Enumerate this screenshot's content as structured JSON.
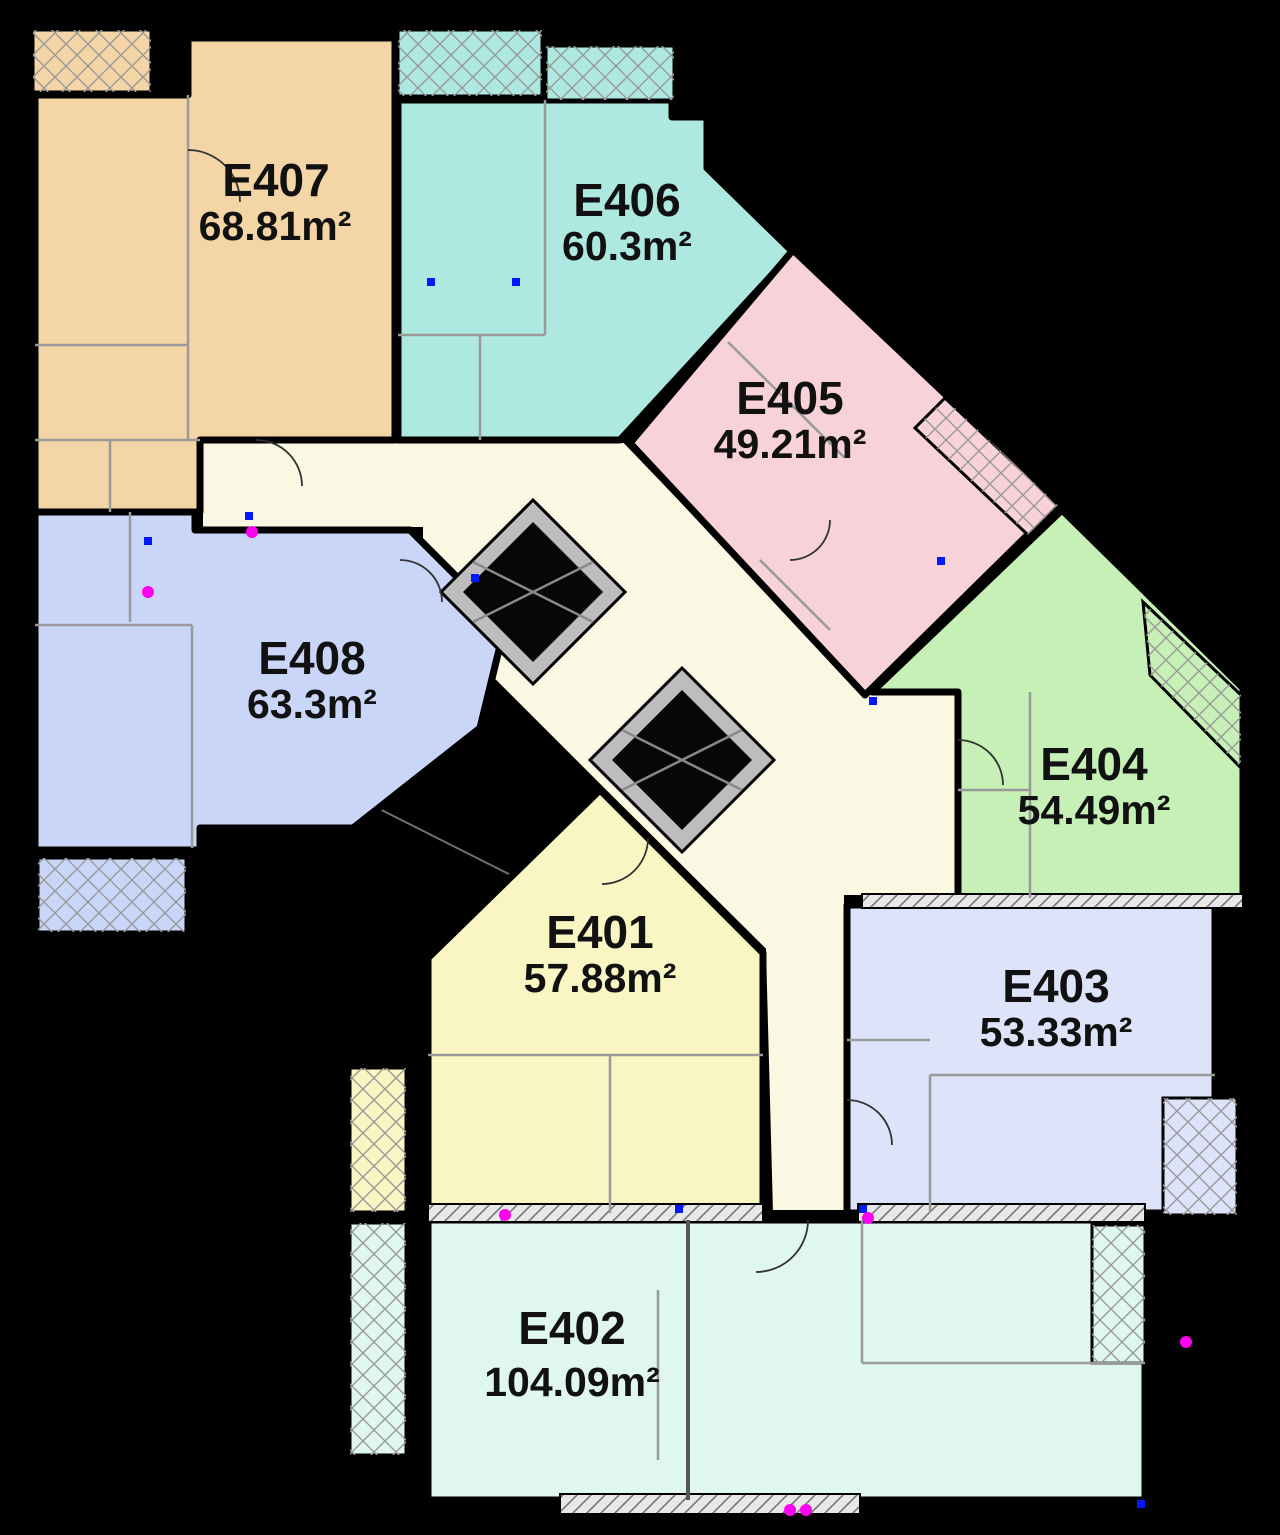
{
  "plan": {
    "type": "apartment-floor-plan",
    "units": [
      {
        "id": "E401",
        "area": "57.88m²",
        "color": "#FAF6C3"
      },
      {
        "id": "E402",
        "area": "104.09m²",
        "color": "#DFF7F0"
      },
      {
        "id": "E403",
        "area": "53.33m²",
        "color": "#DDE3F8"
      },
      {
        "id": "E404",
        "area": "54.49m²",
        "color": "#C6F0B6"
      },
      {
        "id": "E405",
        "area": "49.21m²",
        "color": "#F8D2D9"
      },
      {
        "id": "E406",
        "area": "60.3m²",
        "color": "#ADE9E1"
      },
      {
        "id": "E407",
        "area": "68.81m²",
        "color": "#F4D5A6"
      },
      {
        "id": "E408",
        "area": "63.3m²",
        "color": "#C9D6F7"
      }
    ],
    "colors": {
      "background": "#000000",
      "corridor": "#FAF8E2",
      "wall": "#000000",
      "stairwell": "#000000",
      "elevator_ring": "#BDBDBD",
      "elevator_shaft": "#070707",
      "elevator_cross": "#8a8a8a",
      "hatch_line": "#9a9a9a",
      "wall_hatch_bg": "#ffffff",
      "label_text": "#111111",
      "marker_blue": "#0019ff",
      "marker_magenta": "#ff00f0"
    },
    "icons": {
      "elevator": "crossed-shaft-diamond",
      "staircase": "solid-black-flight"
    }
  }
}
